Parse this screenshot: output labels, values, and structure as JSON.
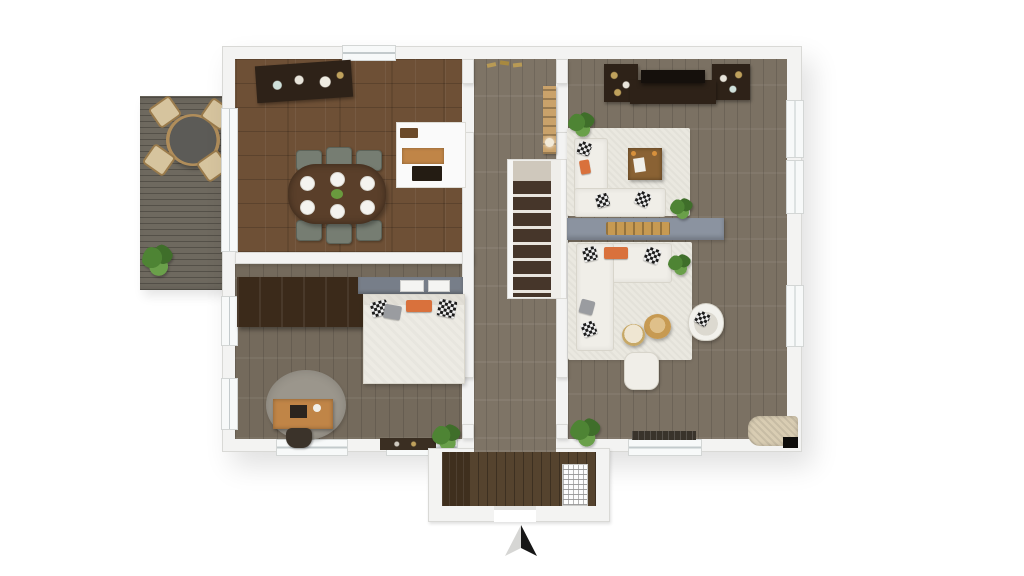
{
  "meta": {
    "title": "3D floor plan render",
    "view": "top-down 3D",
    "text_visible": false
  },
  "compass": {
    "direction": "N",
    "style": "split arrow, light left half, black right half"
  },
  "colors": {
    "bg": "#ffffff",
    "wall": "#f3f3f2",
    "wall_edge": "#d9d9d6",
    "floor_dining": "#6e5036",
    "floor_gray": "#7b7163",
    "floor_bed": "#746a5c",
    "floor_hall": "#7e7466",
    "floor_vestibule": "#55432e",
    "deck": "#6e695f",
    "accent_wall": "#8b93a0",
    "accent_wall_dark": "#777e89",
    "rug_white": "#eae8e0",
    "rug_gray": "#9b968c",
    "sofa": "#f0eee8",
    "sofa_edge": "#d8d5cb",
    "dark_wood": "#2e2218",
    "mid_wood": "#5a3f2a",
    "warm_wood": "#c08547",
    "gold": "#c79a52",
    "tv_black": "#15100c",
    "chair_gray": "#767d72",
    "plant": "#4e8434",
    "plant_dark": "#3f6e2a",
    "orange": "#d9713c",
    "stair_tread": "#46362a",
    "white": "#fafafa"
  },
  "scene": {
    "rooms": [
      {
        "name": "deck",
        "floor": "gray wood planks",
        "furniture": [
          "round outdoor table",
          "4 outdoor chairs",
          "potted plant"
        ]
      },
      {
        "name": "dining-room",
        "floor": "red-brown parquet",
        "furniture": [
          "dark sideboard with dishes",
          "oval dining table",
          "6 gray chairs",
          "plates",
          "kitchen niche with counter and oven"
        ]
      },
      {
        "name": "entry-hall",
        "floor": "gray-brown planks",
        "furniture": [
          "coat hooks",
          "tall shelf cabinet",
          "staircase down"
        ]
      },
      {
        "name": "tv-lounge",
        "floor": "gray-brown planks",
        "furniture": [
          "media console with TV",
          "2 bookshelves",
          "white L-sofa",
          "square wood coffee table",
          "white rug",
          "2 potted plants",
          "gray accent wall with gold console"
        ]
      },
      {
        "name": "living-room",
        "floor": "gray-brown planks",
        "furniture": [
          "white sectional sofa",
          "2 round side tables",
          "white pouf",
          "wicker armchair",
          "white rug",
          "2 potted plants",
          "pet bed",
          "window bench"
        ]
      },
      {
        "name": "bedroom",
        "floor": "gray-brown planks",
        "furniture": [
          "dark wardrobe",
          "double bed with pillows",
          "gray accent wall with art",
          "round gray rug",
          "wood desk",
          "desk chair",
          "low dresser",
          "potted plant"
        ]
      },
      {
        "name": "vestibule",
        "floor": "dark wood planks",
        "furniture": [
          "radiator",
          "entry door opening"
        ]
      }
    ]
  }
}
